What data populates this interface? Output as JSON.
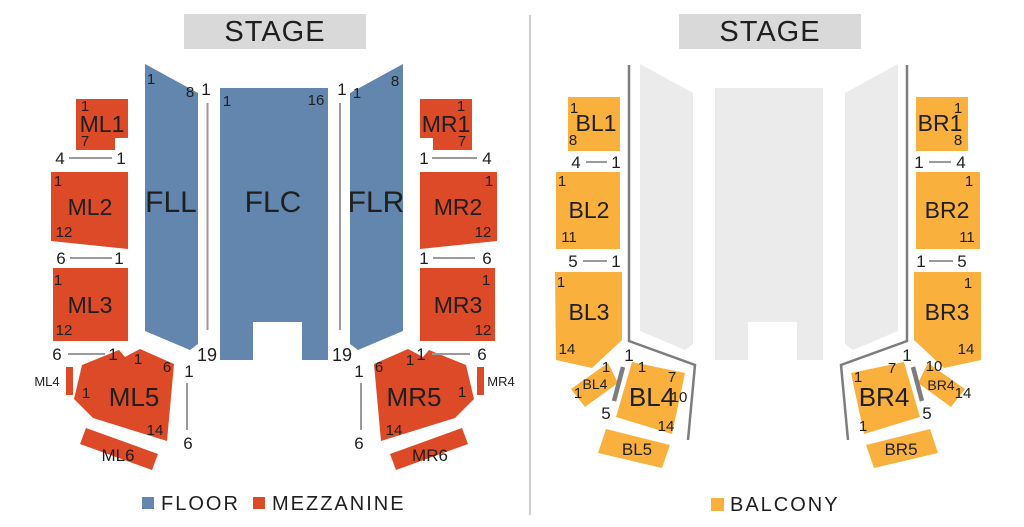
{
  "colors": {
    "floor": "#6286ae",
    "mezzanine": "#dc4a27",
    "balcony": "#f9b03d",
    "floor_disabled": "#ebebeb",
    "stage_bg": "#d9d9d9",
    "stage_text": "#262626",
    "label_text": "#1f1f1f",
    "number_text": "#2b2b2b",
    "marker_line": "#9a9a9a",
    "rail": "#7d7d7d",
    "divider": "#cccccc"
  },
  "left_panel": {
    "stage_label": "STAGE",
    "legend": [
      {
        "label": "FLOOR",
        "color_key": "floor"
      },
      {
        "label": "MEZZANINE",
        "color_key": "mezzanine"
      }
    ]
  },
  "right_panel": {
    "stage_label": "STAGE",
    "legend": [
      {
        "label": "BALCONY",
        "color_key": "balcony"
      }
    ]
  },
  "sections": [
    {
      "name": "fll",
      "cat": "floor",
      "pts": "145,64 198,93 198,344 190,350 145,331",
      "label": "FLL",
      "lx": 171,
      "ly": 212,
      "ls": 30,
      "nums": [
        {
          "t": "1",
          "x": 151,
          "y": 84
        },
        {
          "t": "8",
          "x": 190,
          "y": 97
        }
      ]
    },
    {
      "name": "flc",
      "cat": "floor",
      "pts": "220,88 328,88 328,360 302,360 302,322 253,322 253,360 220,360",
      "label": "FLC",
      "lx": 273,
      "ly": 212,
      "ls": 30,
      "nums": [
        {
          "t": "1",
          "x": 227,
          "y": 106
        },
        {
          "t": "16",
          "x": 316,
          "y": 105
        }
      ]
    },
    {
      "name": "flr",
      "cat": "floor",
      "pts": "403,64 350,93 350,344 358,350 403,331",
      "label": "FLR",
      "lx": 376,
      "ly": 212,
      "ls": 30,
      "nums": [
        {
          "t": "1",
          "x": 357,
          "y": 98
        },
        {
          "t": "8",
          "x": 395,
          "y": 86
        }
      ]
    },
    {
      "name": "ml1",
      "cat": "mezzanine",
      "pts": "76,99 128,99 128,138 115,138 115,150 76,150",
      "label": "ML1",
      "lx": 102,
      "ly": 132,
      "ls": 23,
      "nums": [
        {
          "t": "1",
          "x": 85,
          "y": 111
        },
        {
          "t": "7",
          "x": 85,
          "y": 146
        }
      ]
    },
    {
      "name": "ml2",
      "cat": "mezzanine",
      "pts": "51,172 128,172 128,249 51,241",
      "label": "ML2",
      "lx": 90,
      "ly": 215,
      "ls": 23,
      "nums": [
        {
          "t": "1",
          "x": 58,
          "y": 186
        },
        {
          "t": "12",
          "x": 64,
          "y": 237
        }
      ]
    },
    {
      "name": "ml3",
      "cat": "mezzanine",
      "pts": "53,268 128,268 128,341 53,341",
      "label": "ML3",
      "lx": 90,
      "ly": 313,
      "ls": 23,
      "nums": [
        {
          "t": "1",
          "x": 58,
          "y": 285
        },
        {
          "t": "12",
          "x": 64,
          "y": 335
        }
      ]
    },
    {
      "name": "ml4",
      "cat": "mezzanine",
      "pts": "66,367 73,367 73,395 66,395",
      "label": "ML4",
      "lx": 47,
      "ly": 386,
      "ls": 13
    },
    {
      "name": "ml5",
      "cat": "mezzanine",
      "pts": "82,365 119,350 125,357 140,349 174,364 167,441 93,418 74,399",
      "label": "ML5",
      "lx": 134,
      "ly": 406,
      "ls": 26,
      "nums": [
        {
          "t": "1",
          "x": 138,
          "y": 364
        },
        {
          "t": "6",
          "x": 167,
          "y": 372
        },
        {
          "t": "1",
          "x": 86,
          "y": 398
        },
        {
          "t": "14",
          "x": 155,
          "y": 435
        }
      ]
    },
    {
      "name": "ml6",
      "cat": "mezzanine",
      "pts": "86,428 158,454 152,470 80,444",
      "label": "ML6",
      "lx": 118,
      "ly": 461,
      "ls": 17
    },
    {
      "name": "mr1",
      "cat": "mezzanine",
      "pts": "420,99 472,99 472,150 433,150 433,138 420,138",
      "label": "MR1",
      "lx": 446,
      "ly": 132,
      "ls": 23,
      "nums": [
        {
          "t": "1",
          "x": 461,
          "y": 111
        },
        {
          "t": "7",
          "x": 462,
          "y": 146
        }
      ]
    },
    {
      "name": "mr2",
      "cat": "mezzanine",
      "pts": "420,172 497,172 497,241 420,249",
      "label": "MR2",
      "lx": 458,
      "ly": 215,
      "ls": 23,
      "nums": [
        {
          "t": "1",
          "x": 489,
          "y": 186
        },
        {
          "t": "12",
          "x": 483,
          "y": 237
        }
      ]
    },
    {
      "name": "mr3",
      "cat": "mezzanine",
      "pts": "420,268 495,268 495,341 420,341",
      "label": "MR3",
      "lx": 458,
      "ly": 313,
      "ls": 23,
      "nums": [
        {
          "t": "1",
          "x": 486,
          "y": 285
        },
        {
          "t": "12",
          "x": 483,
          "y": 335
        }
      ]
    },
    {
      "name": "mr4",
      "cat": "mezzanine",
      "pts": "477,367 484,367 484,395 477,395",
      "label": "MR4",
      "lx": 501,
      "ly": 386,
      "ls": 13
    },
    {
      "name": "mr5",
      "cat": "mezzanine",
      "pts": "466,365 429,350 423,357 408,349 374,364 381,441 455,418 474,399",
      "label": "MR5",
      "lx": 414,
      "ly": 406,
      "ls": 26,
      "nums": [
        {
          "t": "1",
          "x": 410,
          "y": 365
        },
        {
          "t": "6",
          "x": 379,
          "y": 372
        },
        {
          "t": "1",
          "x": 462,
          "y": 397
        },
        {
          "t": "14",
          "x": 394,
          "y": 435
        }
      ]
    },
    {
      "name": "mr6",
      "cat": "mezzanine",
      "pts": "462,428 390,454 396,470 468,444",
      "label": "MR6",
      "lx": 430,
      "ly": 461,
      "ls": 17
    },
    {
      "name": "floor-left-disabled",
      "cat": "floor_disabled",
      "pts": "640,64 693,93 693,344 685,350 640,331"
    },
    {
      "name": "floor-center-disabled",
      "cat": "floor_disabled",
      "pts": "715,88 823,88 823,360 797,360 797,322 748,322 748,360 715,360"
    },
    {
      "name": "floor-right-disabled",
      "cat": "floor_disabled",
      "pts": "898,64 845,93 845,344 853,350 898,331"
    },
    {
      "name": "bl1",
      "cat": "balcony",
      "pts": "568,97 620,97 620,151 568,151",
      "label": "BL1",
      "lx": 596,
      "ly": 131,
      "ls": 23,
      "nums": [
        {
          "t": "1",
          "x": 574,
          "y": 113
        },
        {
          "t": "8",
          "x": 573,
          "y": 145
        }
      ]
    },
    {
      "name": "bl2",
      "cat": "balcony",
      "pts": "556,172 620,172 620,249 556,249",
      "label": "BL2",
      "lx": 589,
      "ly": 218,
      "ls": 23,
      "nums": [
        {
          "t": "1",
          "x": 562,
          "y": 186
        },
        {
          "t": "11",
          "x": 569,
          "y": 242
        }
      ]
    },
    {
      "name": "bl3",
      "cat": "balcony",
      "pts": "555,272 622,272 622,340 592,368 556,360",
      "label": "BL3",
      "lx": 589,
      "ly": 320,
      "ls": 23,
      "nums": [
        {
          "t": "1",
          "x": 561,
          "y": 287
        },
        {
          "t": "14",
          "x": 567,
          "y": 354
        }
      ]
    },
    {
      "name": "bl4-small",
      "cat": "balcony",
      "pts": "608,363 618,383 585,407 571,389",
      "label": "BL4",
      "lx": 595,
      "ly": 389,
      "ls": 14,
      "nums": [
        {
          "t": "1",
          "x": 606,
          "y": 372
        },
        {
          "t": "1",
          "x": 578,
          "y": 398
        }
      ]
    },
    {
      "name": "bl4-large",
      "cat": "balcony",
      "pts": "632,362 685,373 672,434 616,417",
      "label": "BL4",
      "lx": 652,
      "ly": 406,
      "ls": 26,
      "nums": [
        {
          "t": "1",
          "x": 642,
          "y": 372
        },
        {
          "t": "7",
          "x": 672,
          "y": 382
        },
        {
          "t": "10",
          "x": 679,
          "y": 402
        },
        {
          "t": "14",
          "x": 666,
          "y": 431
        }
      ]
    },
    {
      "name": "bl5",
      "cat": "balcony",
      "pts": "606,429 670,445 662,468 598,453",
      "label": "BL5",
      "lx": 637,
      "ly": 455,
      "ls": 17
    },
    {
      "name": "br1",
      "cat": "balcony",
      "pts": "916,97 968,97 968,151 916,151",
      "label": "BR1",
      "lx": 940,
      "ly": 131,
      "ls": 23,
      "nums": [
        {
          "t": "1",
          "x": 958,
          "y": 113
        },
        {
          "t": "8",
          "x": 958,
          "y": 145
        }
      ]
    },
    {
      "name": "br2",
      "cat": "balcony",
      "pts": "916,172 980,172 980,249 916,249",
      "label": "BR2",
      "lx": 947,
      "ly": 218,
      "ls": 23,
      "nums": [
        {
          "t": "1",
          "x": 969,
          "y": 186
        },
        {
          "t": "11",
          "x": 967,
          "y": 242
        }
      ]
    },
    {
      "name": "br3",
      "cat": "balcony",
      "pts": "914,272 981,272 981,360 944,368 914,340",
      "label": "BR3",
      "lx": 947,
      "ly": 320,
      "ls": 23,
      "nums": [
        {
          "t": "1",
          "x": 968,
          "y": 288
        },
        {
          "t": "14",
          "x": 966,
          "y": 354
        }
      ]
    },
    {
      "name": "br4-small",
      "cat": "balcony",
      "pts": "928,363 918,383 951,407 965,389",
      "label": "BR4",
      "lx": 941,
      "ly": 390,
      "ls": 14,
      "nums": [
        {
          "t": "10",
          "x": 934,
          "y": 371
        },
        {
          "t": "14",
          "x": 963,
          "y": 398
        }
      ]
    },
    {
      "name": "br4-large",
      "cat": "balcony",
      "pts": "904,362 851,373 864,434 920,417",
      "label": "BR4",
      "lx": 884,
      "ly": 406,
      "ls": 26,
      "nums": [
        {
          "t": "7",
          "x": 892,
          "y": 373
        },
        {
          "t": "1",
          "x": 858,
          "y": 382
        },
        {
          "t": "1",
          "x": 863,
          "y": 431
        }
      ]
    },
    {
      "name": "br5",
      "cat": "balcony",
      "pts": "930,429 866,445 874,468 938,453",
      "label": "BR5",
      "lx": 901,
      "ly": 455,
      "ls": 17
    }
  ],
  "guides": [
    {
      "name": "aisle-line-floor-left",
      "kind": "aisle",
      "pts": "207.5,103 207.5,330",
      "labels": [
        {
          "t": "1",
          "x": 206,
          "y": 95,
          "s": 17
        },
        {
          "t": "19",
          "x": 207,
          "y": 361,
          "s": 18
        }
      ]
    },
    {
      "name": "aisle-line-floor-right",
      "kind": "aisle",
      "pts": "340,103 340,330",
      "labels": [
        {
          "t": "1",
          "x": 342,
          "y": 95,
          "s": 17
        },
        {
          "t": "19",
          "x": 342,
          "y": 361,
          "s": 18
        }
      ]
    },
    {
      "name": "row-line-ml5",
      "kind": "aisle",
      "pts": "187,383 187,430",
      "labels": [
        {
          "t": "1",
          "x": 189,
          "y": 377,
          "s": 17
        },
        {
          "t": "6",
          "x": 188,
          "y": 449,
          "s": 17
        }
      ]
    },
    {
      "name": "row-line-mr5",
      "kind": "aisle",
      "pts": "361,383 361,430",
      "labels": [
        {
          "t": "1",
          "x": 359,
          "y": 377,
          "s": 17
        },
        {
          "t": "6",
          "x": 359,
          "y": 449,
          "s": 17
        }
      ]
    },
    {
      "name": "balcony-rail-left",
      "kind": "rail",
      "pts": "629,65 629,341 695,365 688,440",
      "labels": [
        {
          "t": "1",
          "x": 629,
          "y": 361,
          "s": 17
        }
      ]
    },
    {
      "name": "balcony-rail-right",
      "kind": "rail",
      "pts": "907,65 907,341 841,365 848,440",
      "labels": [
        {
          "t": "1",
          "x": 907,
          "y": 361,
          "s": 17
        }
      ]
    },
    {
      "name": "balcony-stairs-left",
      "kind": "stairs",
      "pts": "623,367 614,401",
      "labels": [
        {
          "t": "5",
          "x": 606,
          "y": 419,
          "s": 17
        }
      ]
    },
    {
      "name": "balcony-stairs-right",
      "kind": "stairs",
      "pts": "913,367 922,401",
      "labels": [
        {
          "t": "5",
          "x": 927,
          "y": 419,
          "s": 17
        }
      ]
    }
  ],
  "row_markers": [
    {
      "name": "rows-ml1",
      "a": "4",
      "b": "1",
      "ax": 60,
      "ay": 164,
      "bx": 121,
      "by": 164,
      "x1": 69,
      "y1": 158,
      "x2": 112,
      "y2": 158
    },
    {
      "name": "rows-ml2",
      "a": "6",
      "b": "1",
      "ax": 61,
      "ay": 264,
      "bx": 119,
      "by": 264,
      "x1": 70,
      "y1": 258,
      "x2": 112,
      "y2": 258
    },
    {
      "name": "rows-ml3",
      "a": "6",
      "b": "1",
      "ax": 57,
      "ay": 360,
      "bx": 113,
      "by": 360,
      "x1": 68,
      "y1": 354,
      "x2": 105,
      "y2": 354
    },
    {
      "name": "rows-mr1",
      "a": "1",
      "b": "4",
      "ax": 424,
      "ay": 164,
      "bx": 487,
      "by": 164,
      "x1": 432,
      "y1": 158,
      "x2": 477,
      "y2": 158
    },
    {
      "name": "rows-mr2",
      "a": "1",
      "b": "6",
      "ax": 424,
      "ay": 264,
      "bx": 487,
      "by": 264,
      "x1": 433,
      "y1": 258,
      "x2": 475,
      "y2": 258
    },
    {
      "name": "rows-mr3",
      "a": "1",
      "b": "6",
      "ax": 421,
      "ay": 360,
      "bx": 482,
      "by": 360,
      "x1": 432,
      "y1": 354,
      "x2": 470,
      "y2": 354
    },
    {
      "name": "rows-bl1",
      "a": "4",
      "b": "1",
      "ax": 576,
      "ay": 168,
      "bx": 616,
      "by": 168,
      "x1": 586,
      "y1": 162,
      "x2": 607,
      "y2": 162
    },
    {
      "name": "rows-bl2",
      "a": "5",
      "b": "1",
      "ax": 573,
      "ay": 267,
      "bx": 616,
      "by": 267,
      "x1": 583,
      "y1": 261,
      "x2": 607,
      "y2": 261
    },
    {
      "name": "rows-br1",
      "a": "1",
      "b": "4",
      "ax": 919,
      "ay": 168,
      "bx": 961,
      "by": 168,
      "x1": 929,
      "y1": 162,
      "x2": 951,
      "y2": 162
    },
    {
      "name": "rows-br2",
      "a": "1",
      "b": "5",
      "ax": 921,
      "ay": 267,
      "bx": 962,
      "by": 267,
      "x1": 929,
      "y1": 261,
      "x2": 953,
      "y2": 261
    }
  ]
}
